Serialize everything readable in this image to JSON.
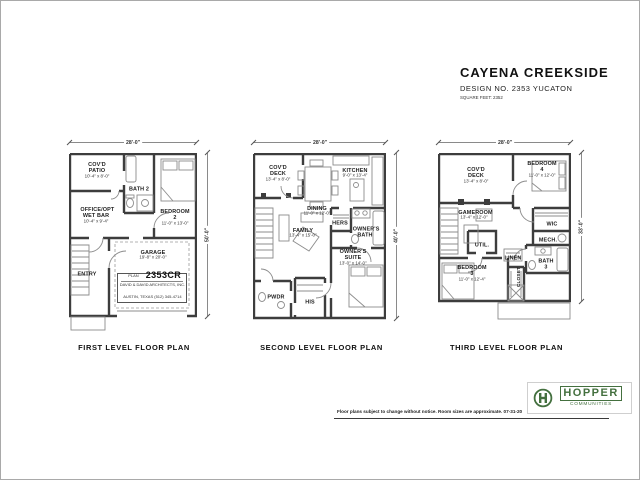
{
  "sheet": {
    "title": "CAYENA CREEKSIDE",
    "design_line": "DESIGN NO. 2353 YUCATON",
    "sqft_line": "SQUARE FEET: 2352"
  },
  "plans": [
    {
      "label": "FIRST LEVEL FLOOR PLAN",
      "dim_top": "28'-0\"",
      "dim_right": "50'-0\"",
      "rooms": [
        {
          "name": "COV'D PATIO",
          "size": "10'-4\" x 8'-0\""
        },
        {
          "name": "BATH 2",
          "size": ""
        },
        {
          "name": "OFFICE/OPT\nWET BAR",
          "size": "10'-4\" x 9'-4\""
        },
        {
          "name": "BEDROOM 2",
          "size": "11'-0\" x 13'-0\""
        },
        {
          "name": "ENTRY",
          "size": ""
        },
        {
          "name": "GARAGE",
          "size": "19'-8\" x 20'-0\""
        }
      ],
      "plan_block": {
        "plan_word": "PLAN",
        "number": "2353CR",
        "firm": "DAVID & DAVID ARCHITECTS, INC.",
        "address": "AUSTIN, TEXAS   (512) 345-4714"
      }
    },
    {
      "label": "SECOND LEVEL FLOOR PLAN",
      "dim_top": "28'-0\"",
      "dim_right": "40'-0\"",
      "rooms": [
        {
          "name": "COV'D DECK",
          "size": "13'-4\" x 8'-0\""
        },
        {
          "name": "KITCHEN",
          "size": "9'-0\" x 13'-4\""
        },
        {
          "name": "DINING",
          "size": "11'-0\" x 12'-0\""
        },
        {
          "name": "FAMILY",
          "size": "13'-4\" x 15'-0\""
        },
        {
          "name": "HERS",
          "size": ""
        },
        {
          "name": "OWNER'S\nBATH",
          "size": ""
        },
        {
          "name": "OWNER'S\nSUITE",
          "size": "13'-0\" x 14'-0\""
        },
        {
          "name": "PWDR",
          "size": ""
        },
        {
          "name": "HIS",
          "size": ""
        }
      ]
    },
    {
      "label": "THIRD LEVEL FLOOR PLAN",
      "dim_top": "28'-0\"",
      "dim_right": "33'-0\"",
      "rooms": [
        {
          "name": "COV'D DECK",
          "size": "13'-4\" x 8'-0\""
        },
        {
          "name": "BEDROOM 4",
          "size": "11'-0\" x 12'-0\""
        },
        {
          "name": "GAMEROOM",
          "size": "13'-4\" x 12'-0\""
        },
        {
          "name": "WIC",
          "size": ""
        },
        {
          "name": "UTIL.",
          "size": ""
        },
        {
          "name": "MECH.",
          "size": ""
        },
        {
          "name": "BATH 3",
          "size": ""
        },
        {
          "name": "LINEN",
          "size": ""
        },
        {
          "name": "BEDROOM 3",
          "size": "11'-0\" x 12'-4\""
        },
        {
          "name": "CLOSET",
          "size": ""
        }
      ]
    }
  ],
  "footer": {
    "disclaimer": "Floor plans subject to change without notice.  Room sizes are approximate.  07-31-20",
    "logo": {
      "letter": "H",
      "word": "HOPPER",
      "sub": "COMMUNITIES",
      "color": "#44703f"
    }
  }
}
